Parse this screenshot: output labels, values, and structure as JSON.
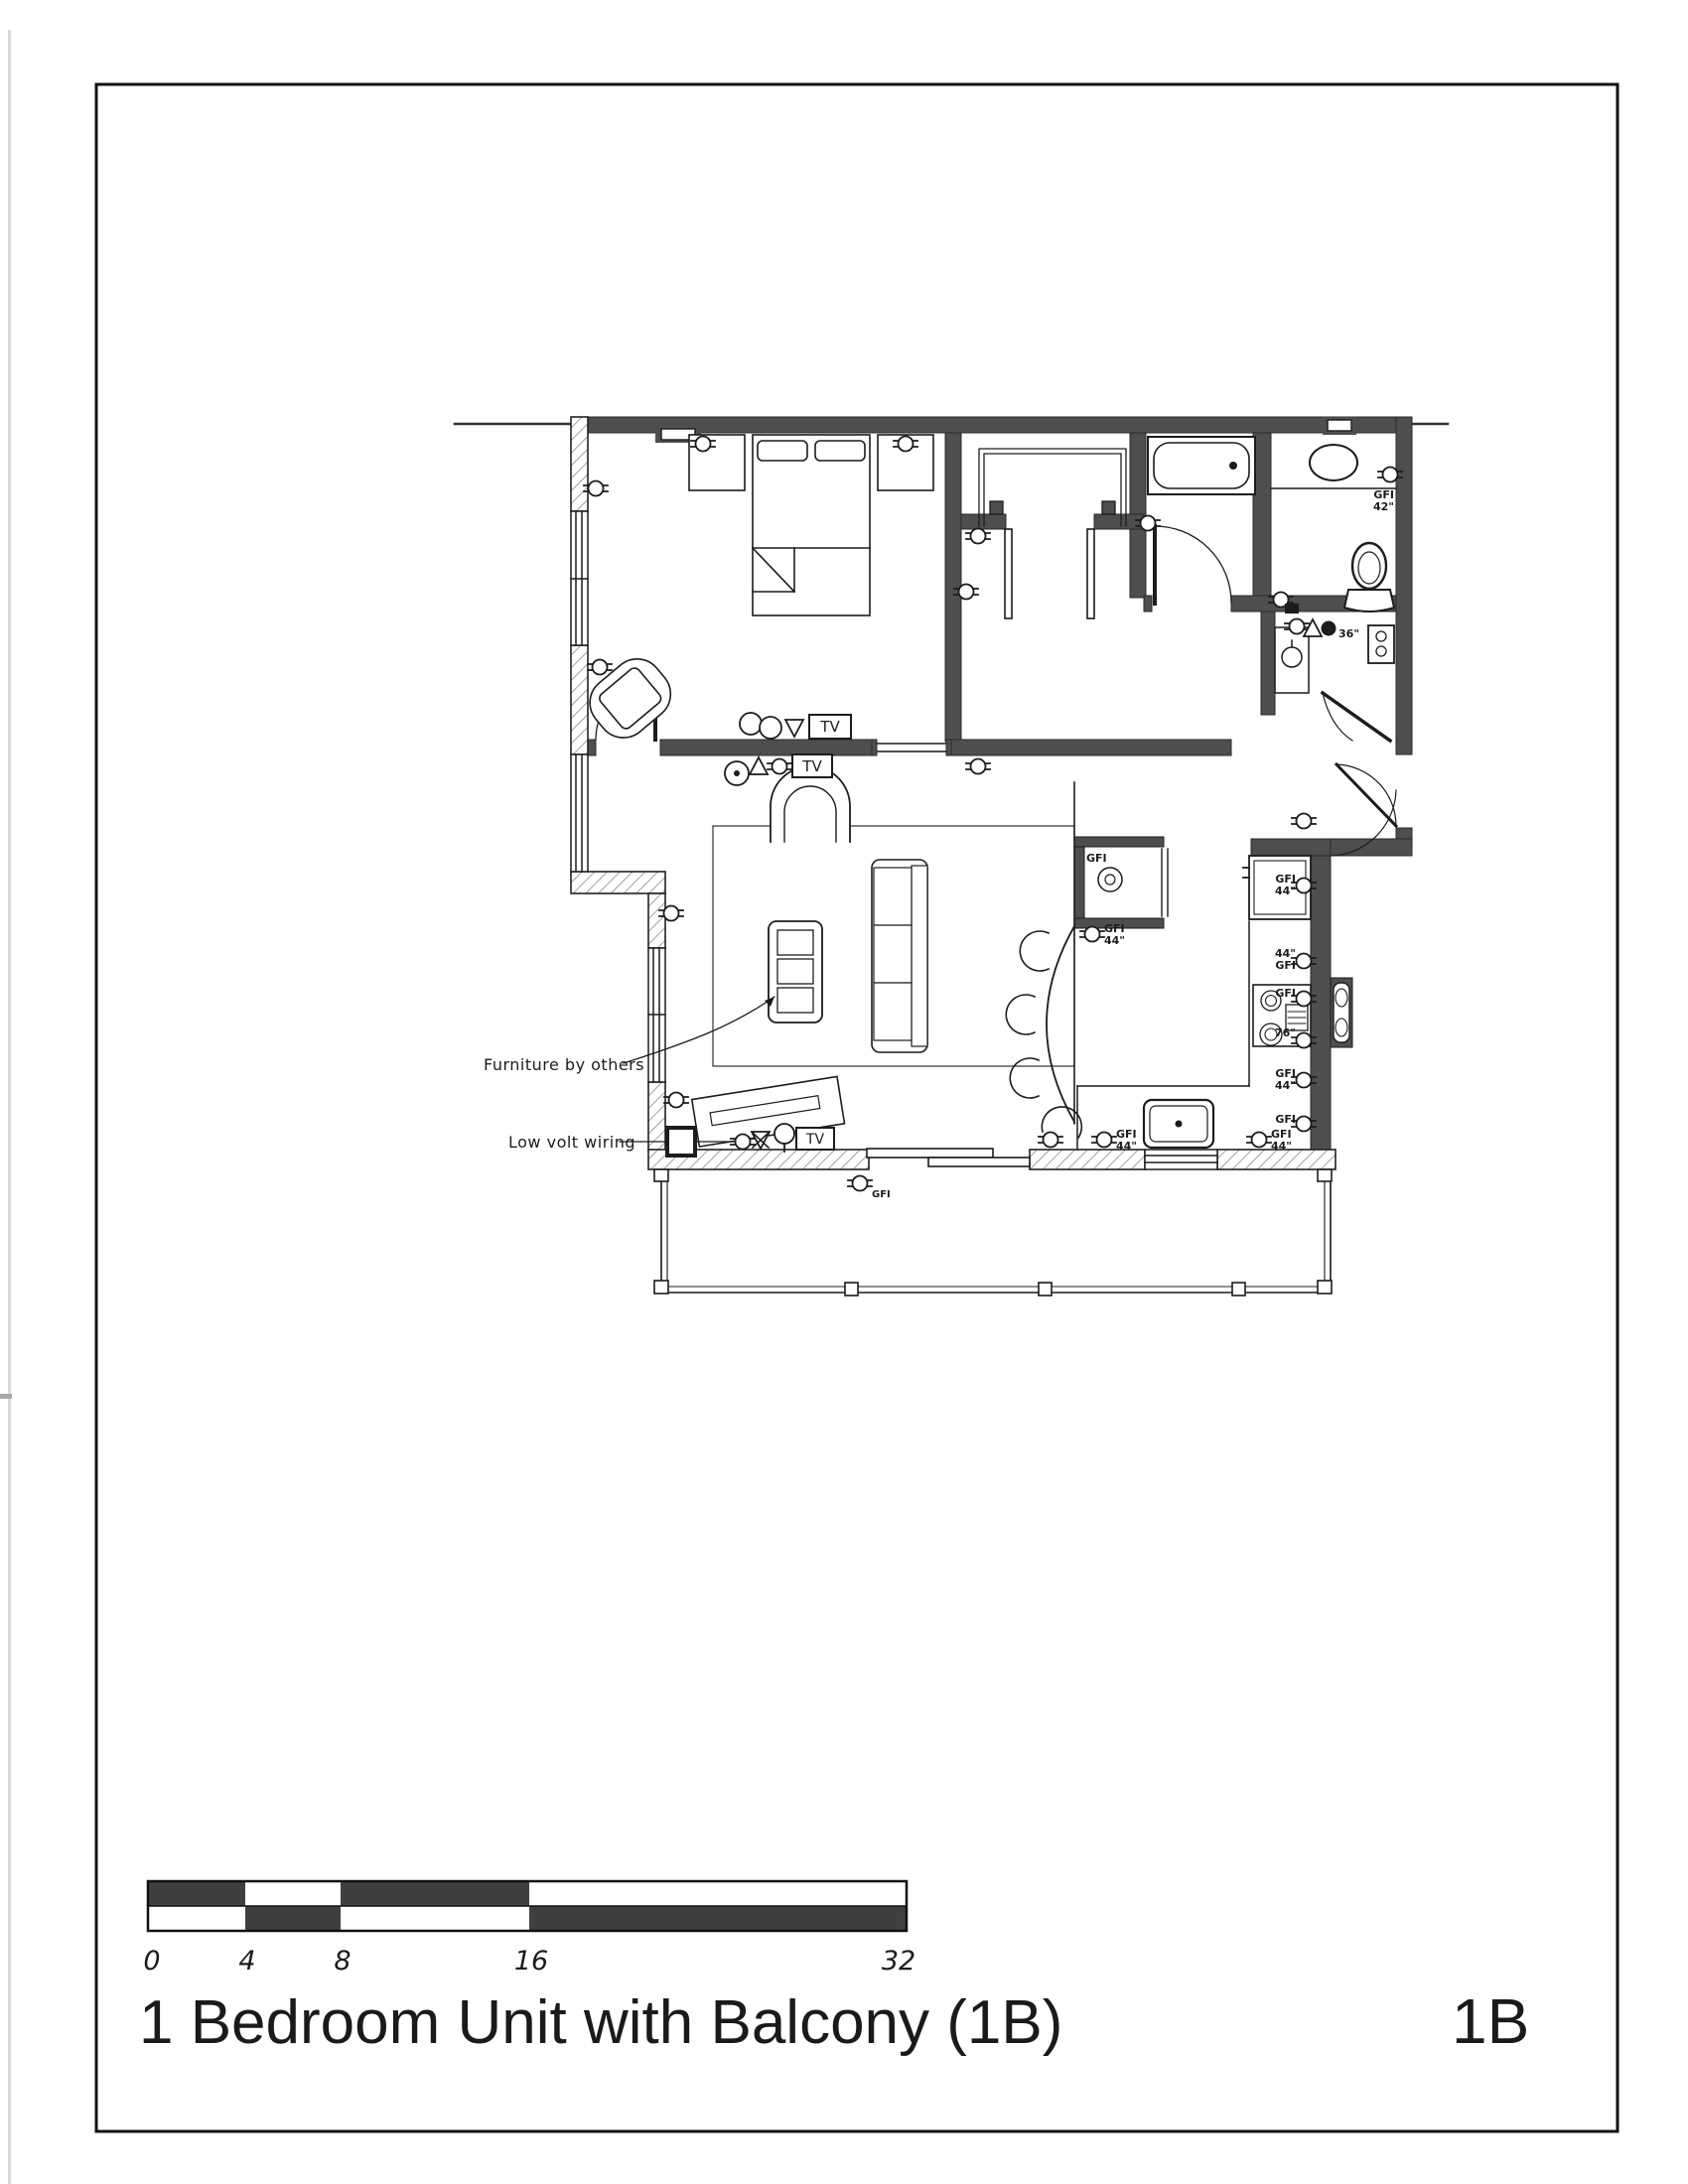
{
  "page": {
    "title": "1 Bedroom Unit with Balcony (1B)",
    "sheet_code": "1B"
  },
  "scale_bar": {
    "labels": [
      "0",
      "4",
      "8",
      "16",
      "32"
    ]
  },
  "annotations": {
    "furniture_note": "Furniture by others",
    "low_volt_note": "Low volt wiring"
  },
  "symbols": {
    "tv": "TV",
    "gfi": "GFI",
    "num_44": "44\"",
    "num_42": "42\"",
    "num_76": "76\"",
    "num_36": "36\""
  },
  "colors": {
    "wall": "#4e4e4e",
    "line": "#1c1c1c",
    "hatch": "#8a8a8a",
    "paper": "#ffffff"
  }
}
